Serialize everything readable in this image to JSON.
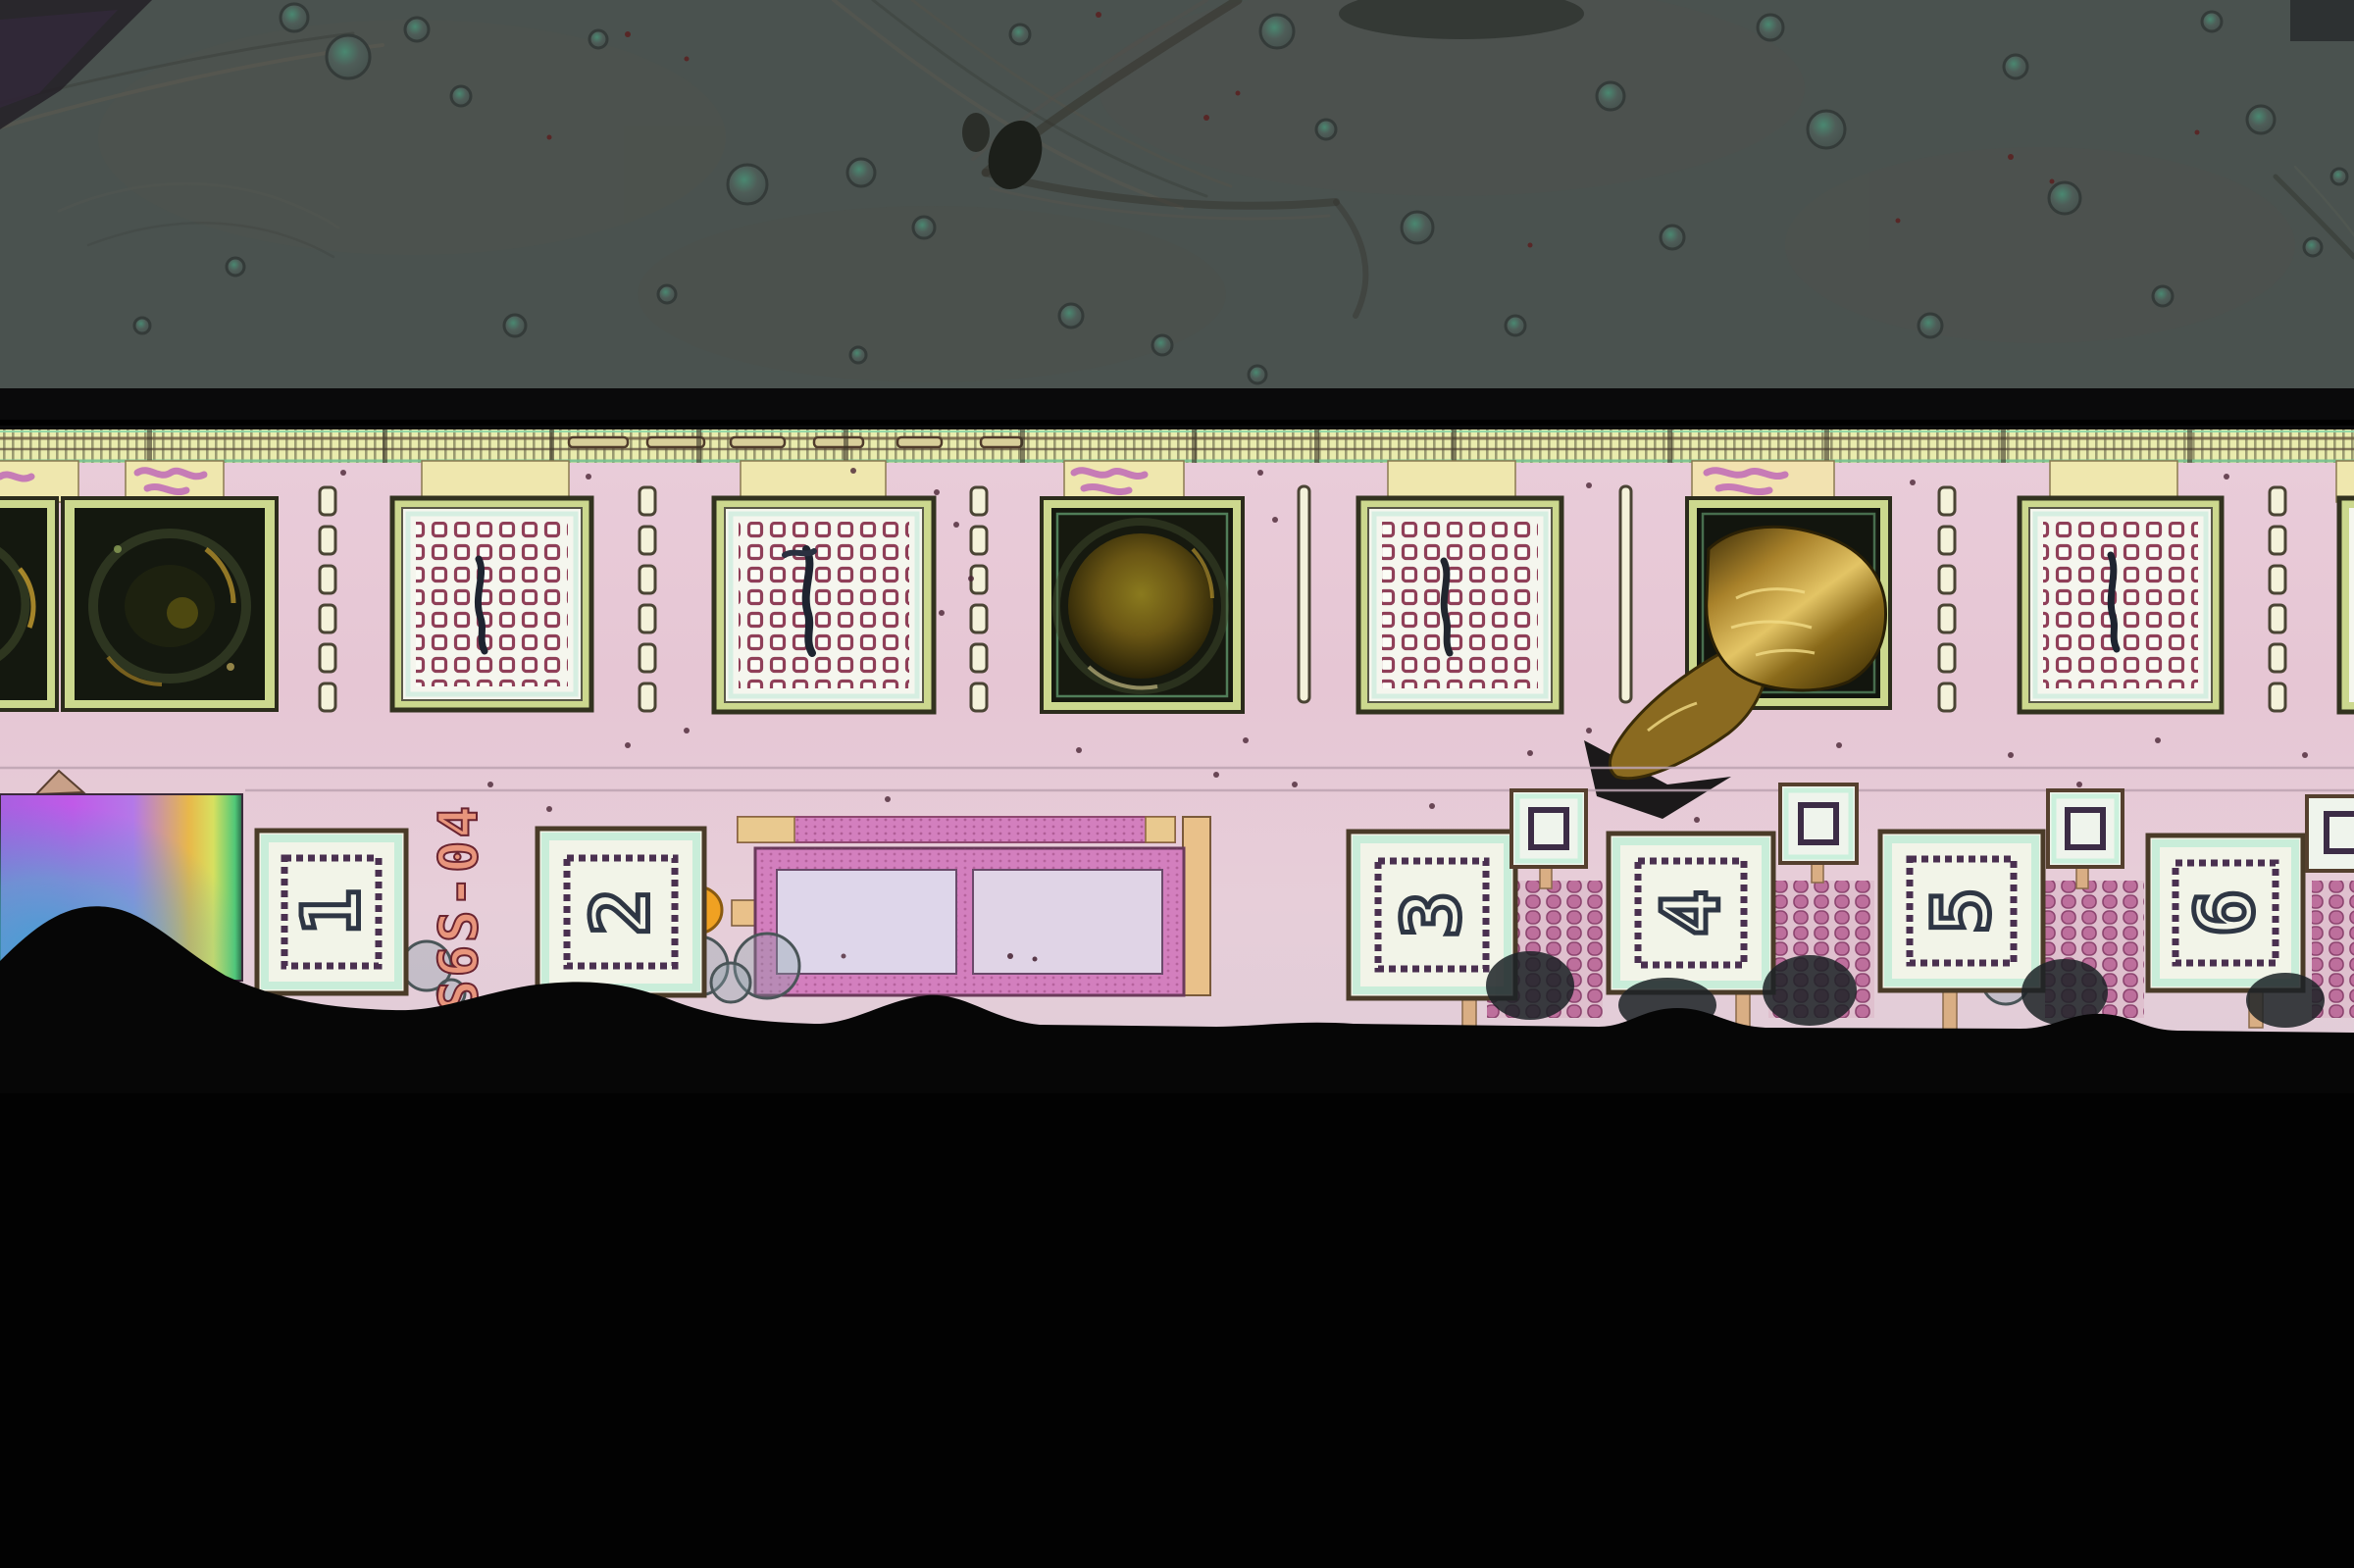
{
  "scene": {
    "type": "optical-micrograph",
    "subject": "integrated-circuit die edge with bond pad row and numbered probe pads",
    "regions": [
      "encapsulant with gas bubbles (top)",
      "black interface band",
      "seal-ring comb strip",
      "bond-pad row (via-grid, bonded-dark, gold-foil debris)",
      "numbered probe pads with die label",
      "out-of-focus black edge (bottom)"
    ]
  },
  "labels": {
    "chip_id": "S6S-04"
  },
  "probe_pads": [
    {
      "label": "1"
    },
    {
      "label": "2"
    },
    {
      "label": "3"
    },
    {
      "label": "4"
    },
    {
      "label": "5"
    },
    {
      "label": "6"
    }
  ],
  "bond_pad_row": {
    "visible_pads": 9,
    "pads": [
      {
        "type": "bonded-dark",
        "partial": true
      },
      {
        "type": "bonded-dark"
      },
      {
        "type": "via-grid"
      },
      {
        "type": "via-grid"
      },
      {
        "type": "bonded-dark-ball"
      },
      {
        "type": "via-grid"
      },
      {
        "type": "gold-foil-debris"
      },
      {
        "type": "via-grid"
      },
      {
        "type": "via-grid",
        "partial": true
      }
    ]
  },
  "marker_squares": {
    "count": 4
  },
  "colors": {
    "encapsulant": "#4a524f",
    "black_band": "#0a0a0b",
    "seal_ring": "#e9ecad",
    "die_pink": "#e8cad8",
    "pad_white": "#f3f5ea",
    "pad_border_olive": "#ccd88e",
    "via_ring": "#8f3f58",
    "burnt_pad": "#14180f",
    "gold_foil": "#c39a33",
    "slot_fill": "#f4f2da",
    "irid_purple": "#bb5ce4",
    "irid_cyan": "#3e9fd4",
    "irid_yellow": "#e8c04a",
    "marker_white": "#eff4ec",
    "stitch_border": "#4a3050",
    "digit_outline": "#2e3644",
    "chip_id_text": "#e8957c",
    "hatch_magenta": "#bd6f9c",
    "frame_magenta": "#d37fbe",
    "tan_trace": "#e9c18a",
    "orange_dot": "#f0a122",
    "bottom_black": "#060606"
  }
}
